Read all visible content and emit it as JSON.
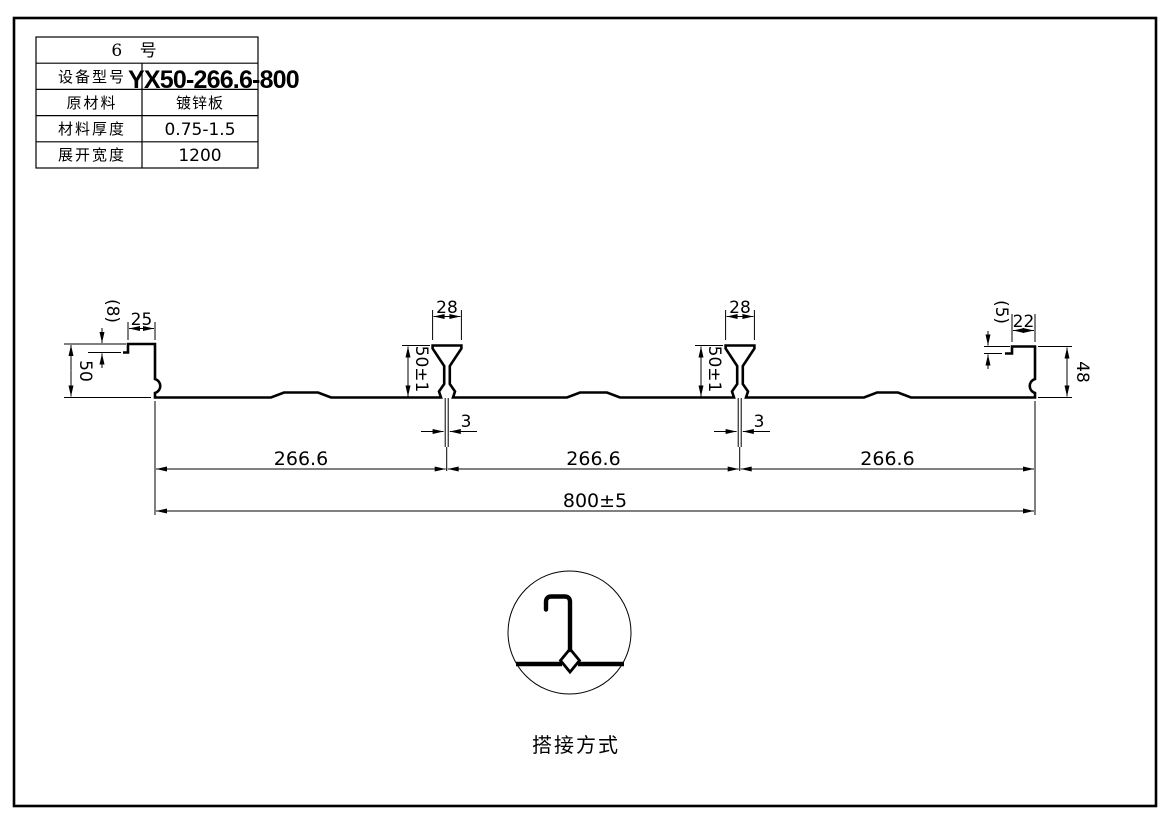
{
  "page": {
    "background": "#ffffff",
    "line_color": "#000000"
  },
  "title_block": {
    "header": "6  号",
    "rows": [
      {
        "label": "设备型号",
        "value": "YX50-266.6-800"
      },
      {
        "label": "原材料",
        "value": "镀锌板"
      },
      {
        "label": "材料厚度",
        "value": "0.75-1.5"
      },
      {
        "label": "展开宽度",
        "value": "1200"
      }
    ]
  },
  "dims": {
    "left_step": "(8)",
    "left_top_width": "25",
    "left_height": "50",
    "rib1_width": "28",
    "rib1_height": "50±1",
    "rib1_slot": "3",
    "rib2_width": "28",
    "rib2_height": "50±1",
    "rib2_slot": "3",
    "right_step": "(5)",
    "right_top_width": "22",
    "right_height": "48",
    "span1": "266.6",
    "span2": "266.6",
    "span3": "266.6",
    "overall_width": "800±5"
  },
  "detail": {
    "caption": "搭接方式"
  }
}
